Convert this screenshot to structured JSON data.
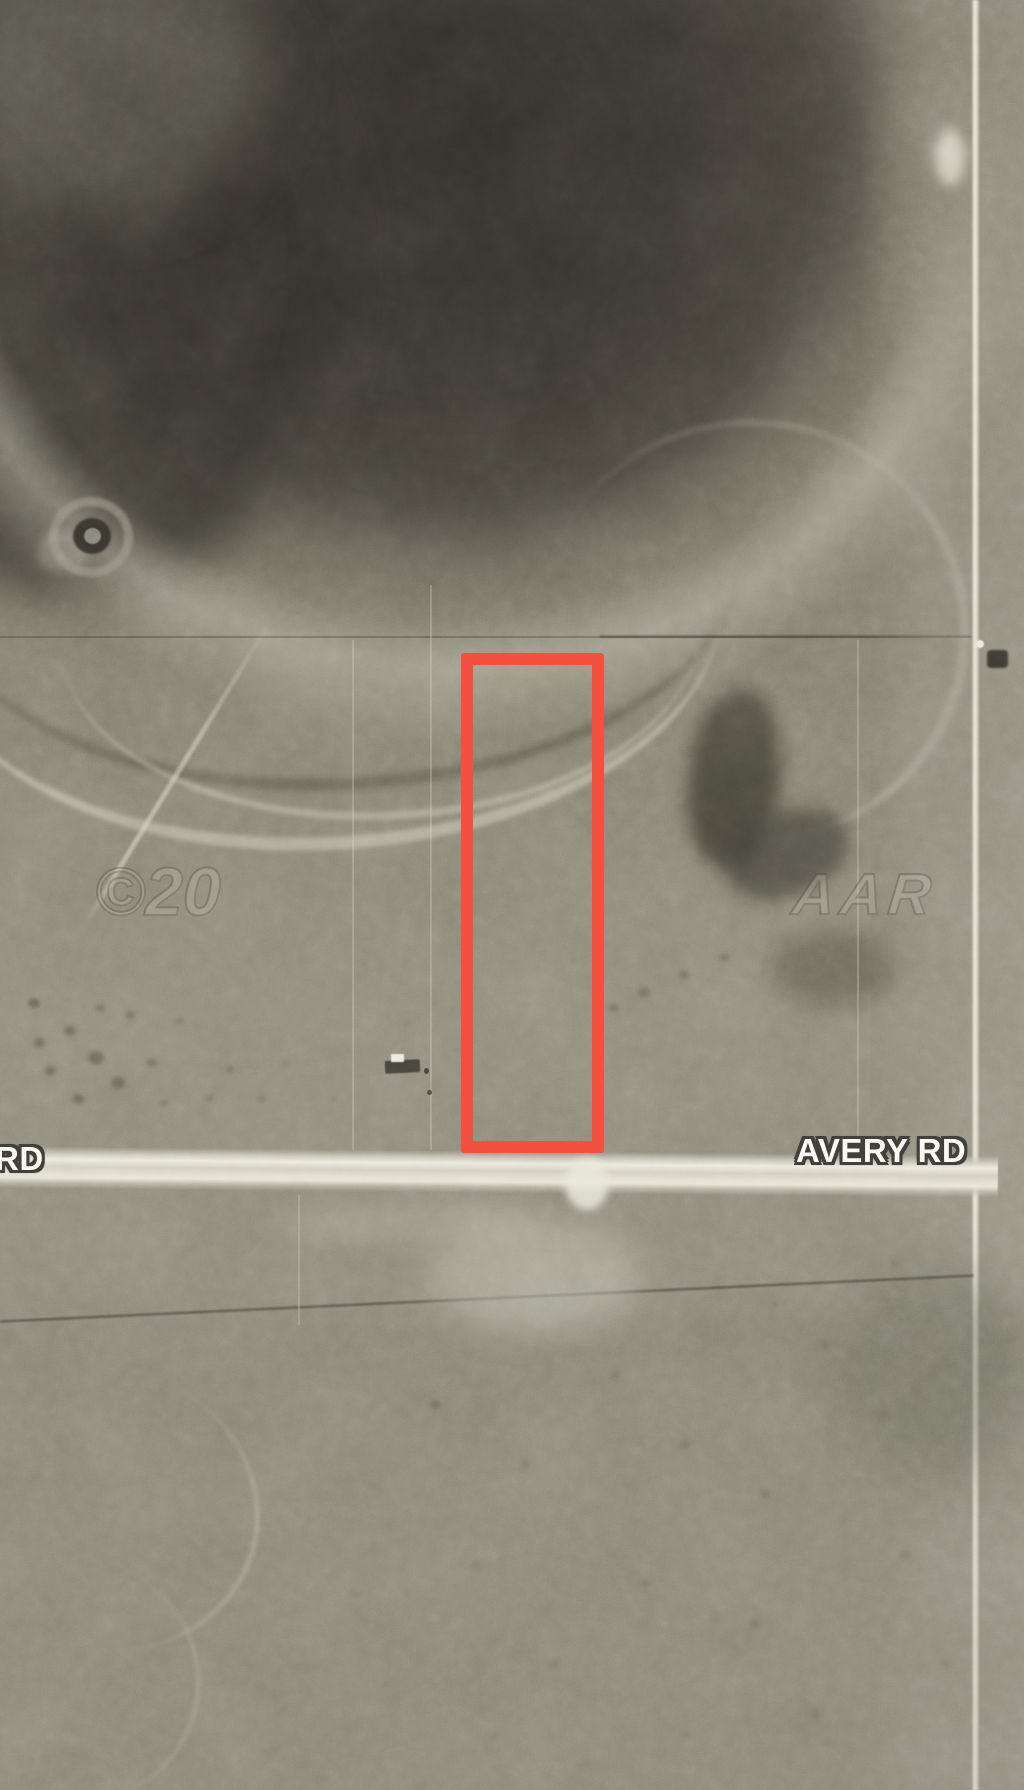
{
  "map": {
    "kind": "aerial-satellite-parcel-map",
    "labels": {
      "avery_rd": "AVERY RD",
      "rd_partial": "RD"
    },
    "watermark": {
      "prefix": "©20",
      "suffix": "AAR"
    },
    "colors": {
      "parcel_outline": "#f45040",
      "road_label_fill": "#faf9f2",
      "road_label_outline": "#42403a"
    }
  }
}
